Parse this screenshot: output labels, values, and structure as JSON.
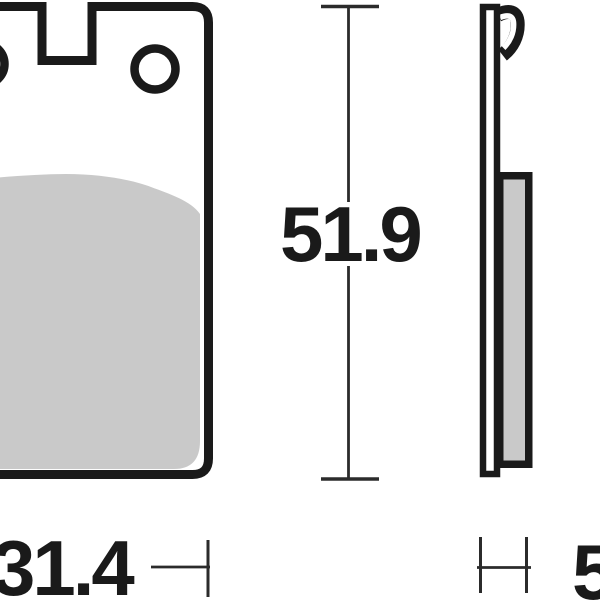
{
  "diagram": {
    "dimensions": {
      "height": {
        "value": "51.9"
      },
      "width": {
        "value": "31.4"
      },
      "thickness": {
        "value": "5"
      }
    },
    "colors": {
      "ink": "#1a1a1a",
      "pad_gray": "#c9c9c9",
      "dim_line": "#2b2b2b",
      "background": "#ffffff"
    }
  }
}
